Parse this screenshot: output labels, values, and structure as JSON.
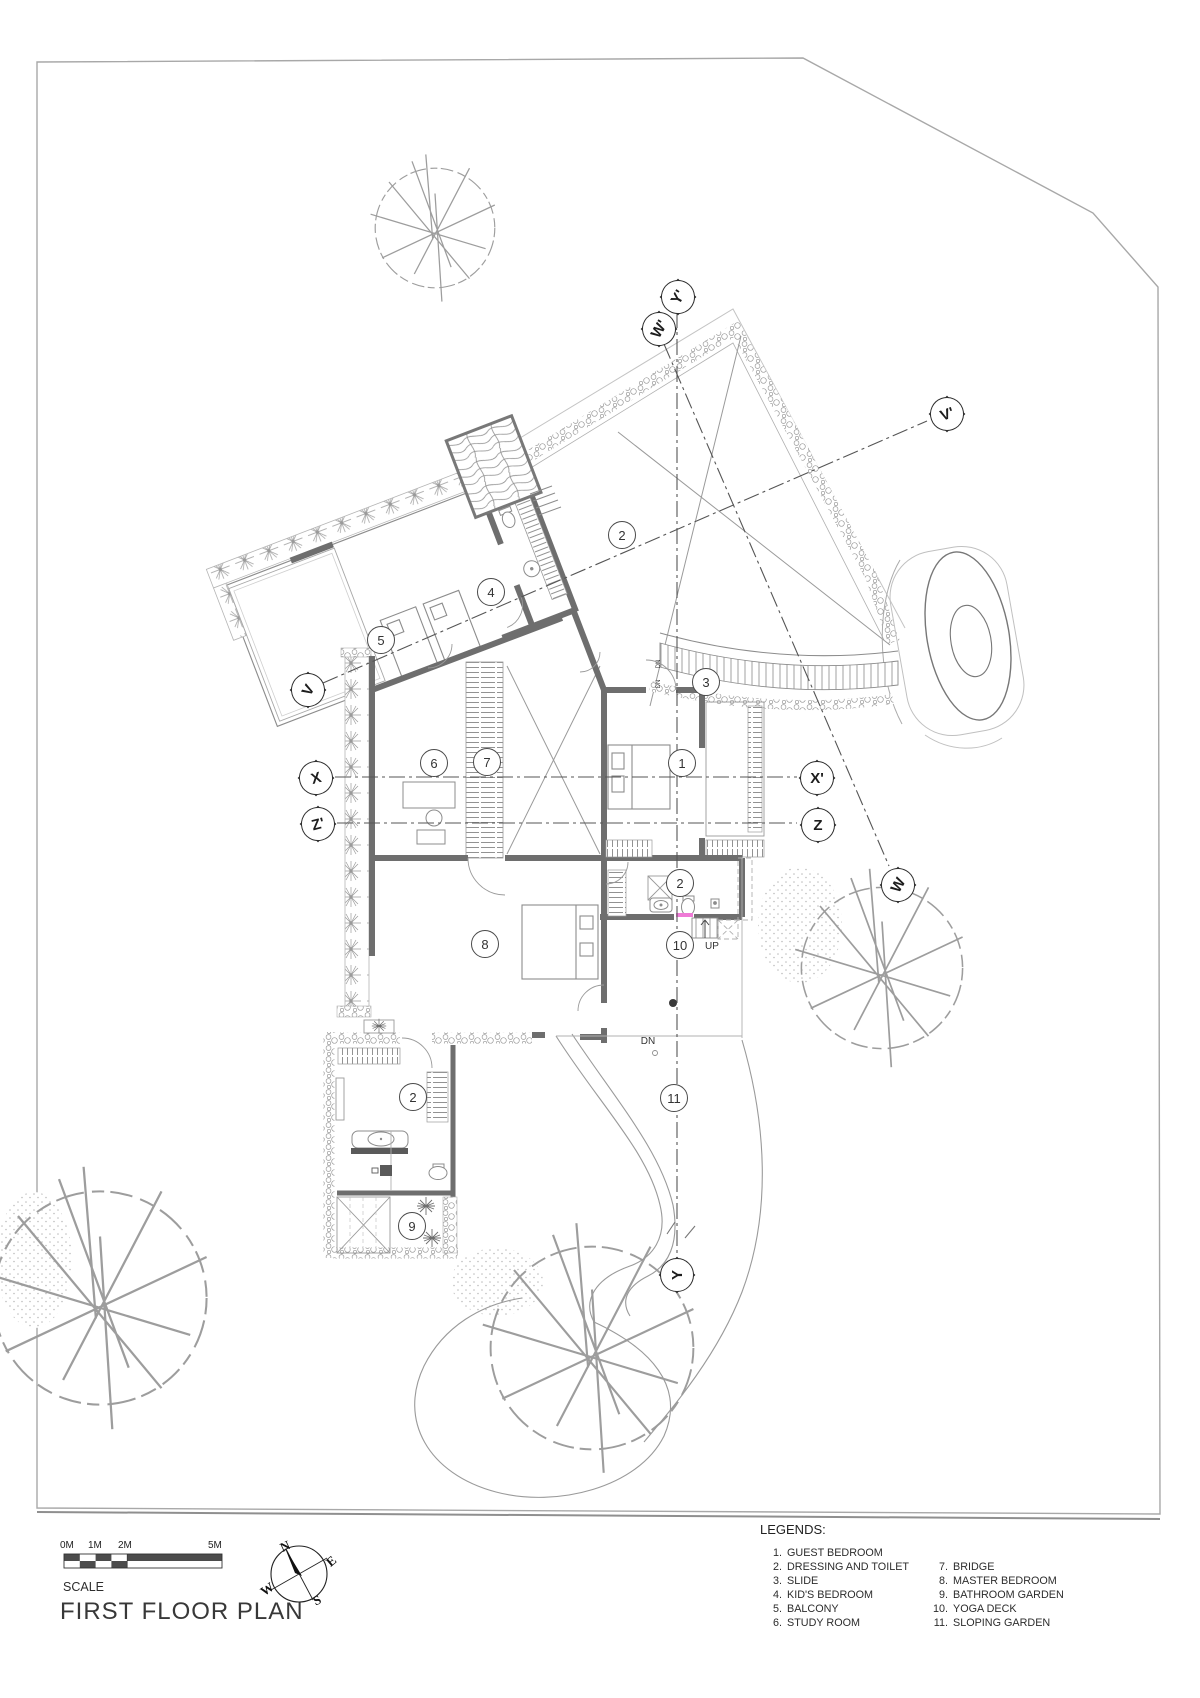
{
  "plan": {
    "title": "FIRST FLOOR PLAN",
    "scale": {
      "label": "SCALE",
      "ticks": [
        {
          "t": "0M",
          "x": 60,
          "y": 1551
        },
        {
          "t": "1M",
          "x": 88,
          "y": 1551
        },
        {
          "t": "2M",
          "x": 118,
          "y": 1551
        },
        {
          "t": "5M",
          "x": 208,
          "y": 1551
        }
      ]
    },
    "compass": {
      "letters": [
        {
          "t": "N",
          "x": 285,
          "y": 1546,
          "rot": -25
        },
        {
          "t": "E",
          "x": 331,
          "y": 1561,
          "rot": -40
        },
        {
          "t": "W",
          "x": 267,
          "y": 1589,
          "rot": -35
        },
        {
          "t": "S",
          "x": 317,
          "y": 1600,
          "rot": -25
        }
      ]
    },
    "legends": {
      "heading": "LEGENDS:",
      "col1": [
        {
          "num": "1.",
          "label": "GUEST BEDROOM",
          "x": 762,
          "y": 1548
        },
        {
          "num": "2.",
          "label": "DRESSING AND TOILET",
          "x": 762,
          "y": 1562
        },
        {
          "num": "3.",
          "label": "SLIDE",
          "x": 762,
          "y": 1576
        },
        {
          "num": "4.",
          "label": "KID'S BEDROOM",
          "x": 762,
          "y": 1590
        },
        {
          "num": "5.",
          "label": "BALCONY",
          "x": 762,
          "y": 1604
        },
        {
          "num": "6.",
          "label": "STUDY ROOM",
          "x": 762,
          "y": 1618
        }
      ],
      "col2": [
        {
          "num": "7.",
          "label": "BRIDGE",
          "x": 928,
          "y": 1562
        },
        {
          "num": "8.",
          "label": "MASTER BEDROOM",
          "x": 928,
          "y": 1576
        },
        {
          "num": "9.",
          "label": "BATHROOM GARDEN",
          "x": 928,
          "y": 1590
        },
        {
          "num": "10.",
          "label": "YOGA DECK",
          "x": 928,
          "y": 1604
        },
        {
          "num": "11.",
          "label": "SLOPING GARDEN",
          "x": 928,
          "y": 1618
        }
      ]
    },
    "room_labels": [
      {
        "n": "2",
        "x": 621,
        "y": 534
      },
      {
        "n": "4",
        "x": 490,
        "y": 591
      },
      {
        "n": "5",
        "x": 380,
        "y": 639
      },
      {
        "n": "3",
        "x": 705,
        "y": 681
      },
      {
        "n": "6",
        "x": 433,
        "y": 762
      },
      {
        "n": "7",
        "x": 486,
        "y": 761
      },
      {
        "n": "1",
        "x": 681,
        "y": 762
      },
      {
        "n": "2",
        "x": 679,
        "y": 882
      },
      {
        "n": "8",
        "x": 484,
        "y": 943
      },
      {
        "n": "10",
        "x": 679,
        "y": 944
      },
      {
        "n": "2",
        "x": 412,
        "y": 1096
      },
      {
        "n": "11",
        "x": 673,
        "y": 1097
      },
      {
        "n": "9",
        "x": 411,
        "y": 1225
      }
    ],
    "section_markers": [
      {
        "l": "Y'",
        "x": 677,
        "y": 296,
        "rot": -60
      },
      {
        "l": "W'",
        "x": 658,
        "y": 328,
        "rot": -60
      },
      {
        "l": "V'",
        "x": 946,
        "y": 413,
        "rot": -20
      },
      {
        "l": "V",
        "x": 307,
        "y": 689,
        "rot": -60
      },
      {
        "l": "X",
        "x": 315,
        "y": 777,
        "rot": -15
      },
      {
        "l": "Z'",
        "x": 317,
        "y": 823,
        "rot": -15
      },
      {
        "l": "X'",
        "x": 816,
        "y": 777,
        "rot": 0
      },
      {
        "l": "Z",
        "x": 817,
        "y": 824,
        "rot": 0
      },
      {
        "l": "W",
        "x": 897,
        "y": 884,
        "rot": -60
      },
      {
        "l": "Y",
        "x": 676,
        "y": 1274,
        "rot": -90
      }
    ],
    "misc_labels": [
      {
        "t": "UP",
        "x": 712,
        "y": 947,
        "fs": 10
      },
      {
        "t": "DN",
        "x": 648,
        "y": 1042,
        "fs": 10
      },
      {
        "t": "DN",
        "x": 659,
        "y": 664,
        "fs": 6,
        "rot": -90
      },
      {
        "t": "DN",
        "x": 659,
        "y": 684,
        "fs": 6,
        "rot": -90
      }
    ],
    "colors": {
      "wall_dark": "#6e6e6e",
      "line": "#8c8c8c",
      "line_light": "#c0c0c0",
      "boundary": "#a8a8a8",
      "section_line": "#555555",
      "accent_pink": "#ef7ad6",
      "text": "#333333"
    }
  }
}
